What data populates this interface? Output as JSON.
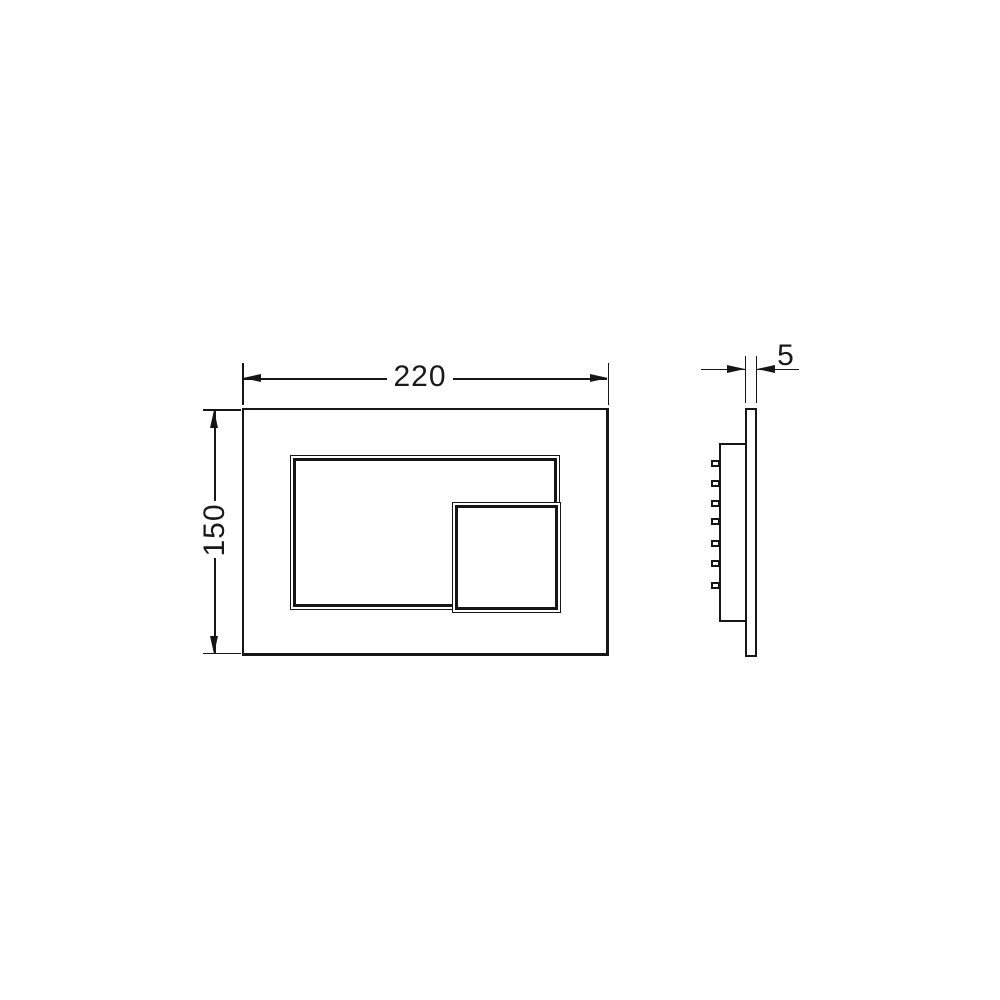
{
  "meta": {
    "type": "technical-drawing",
    "subject": "wall flush plate, front and side elevation with dimensions"
  },
  "colors": {
    "background": "#ffffff",
    "line": "#161616",
    "text": "#1a1a1a"
  },
  "views": {
    "front": {
      "name": "front view",
      "dimensions": {
        "width": {
          "label": "220",
          "value": 220,
          "orientation": "horizontal"
        },
        "height": {
          "label": "150",
          "value": 150,
          "orientation": "vertical"
        }
      },
      "features": [
        "outer plate",
        "large flush button outline",
        "small flush button outline overlapping bottom-right corner"
      ]
    },
    "side": {
      "name": "side view",
      "dimensions": {
        "thickness": {
          "label": "5",
          "value": 5,
          "orientation": "horizontal"
        }
      },
      "mounting_clips": {
        "count": 7,
        "y_positions": [
          460,
          480,
          500,
          518,
          540,
          560,
          582
        ]
      }
    }
  }
}
